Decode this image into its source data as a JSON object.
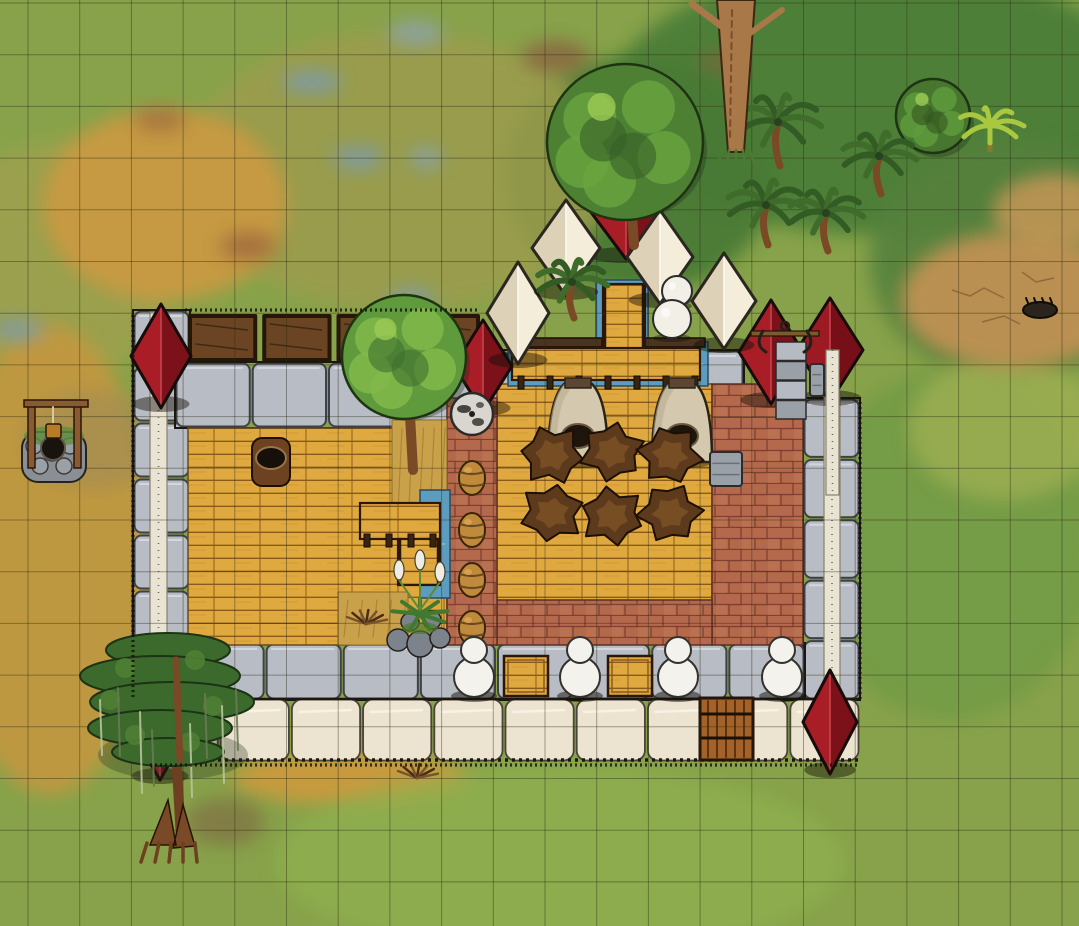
{
  "map": {
    "canvas": {
      "width": 1079,
      "height": 926
    },
    "grid": {
      "cell": 51.7,
      "offset_x": 28,
      "offset_y": 3,
      "color": "#2e2c14",
      "opacity": 0.42
    },
    "palette": {
      "grass_base": "#87a24a",
      "grass_dark": "#4c7e37",
      "grass_fresh": "#8fb14f",
      "dry_gold": "#c99a42",
      "marsh_olive": "#9c9c4e",
      "dirt_tan": "#bd9152",
      "water": "#5b9cbf",
      "stone_light": "#b8bcc5",
      "plaster_cream": "#ece4d0",
      "beam_white": "#e9e3d3",
      "wood_plank": "#e0a93f",
      "wood_line": "#8a5a1b",
      "brick": "#b4684c",
      "brick_line": "#7e4030",
      "roof_red": "#a81d26",
      "roof_red_dark": "#7c1119",
      "tent_white": "#f3edda",
      "tent_shade": "#ddd2b8",
      "canopy_green": "#4e8034",
      "trunk_brown": "#8b5a2b",
      "hide_brown": "#5e3a1c",
      "kiln_beige": "#d4c9ae",
      "ink": "#1c1710"
    },
    "terrain_patches": [
      {
        "name": "dark-grass-north",
        "cx": 880,
        "cy": 100,
        "rx": 270,
        "ry": 135,
        "color": "#4c7e37",
        "opacity": 0.95
      },
      {
        "name": "dark-grass-northeast",
        "cx": 1010,
        "cy": 260,
        "rx": 140,
        "ry": 120,
        "color": "#55813c",
        "opacity": 0.9
      },
      {
        "name": "dark-grass-trees",
        "cx": 640,
        "cy": 175,
        "rx": 135,
        "ry": 118,
        "color": "#497a35",
        "opacity": 0.95
      },
      {
        "name": "grass-east",
        "cx": 950,
        "cy": 545,
        "rx": 145,
        "ry": 175,
        "color": "#6f9a45",
        "opacity": 0.75
      },
      {
        "name": "marsh-olive",
        "cx": 400,
        "cy": 170,
        "rx": 215,
        "ry": 140,
        "color": "#9c9c4e",
        "opacity": 0.85
      },
      {
        "name": "marsh-left",
        "cx": 60,
        "cy": 260,
        "rx": 120,
        "ry": 120,
        "color": "#a3a050",
        "opacity": 0.7
      },
      {
        "name": "gold-topleft",
        "cx": 165,
        "cy": 205,
        "rx": 122,
        "ry": 96,
        "color": "#c99a42",
        "opacity": 0.95
      },
      {
        "name": "gold-left",
        "cx": 50,
        "cy": 560,
        "rx": 102,
        "ry": 235,
        "color": "#c4973f",
        "opacity": 0.9
      },
      {
        "name": "gold-bottom-strip",
        "cx": 350,
        "cy": 778,
        "rx": 118,
        "ry": 27,
        "color": "#cf9a3c",
        "opacity": 0.9
      },
      {
        "name": "fresh-grass-south",
        "cx": 560,
        "cy": 862,
        "rx": 285,
        "ry": 95,
        "color": "#8fb14f",
        "opacity": 0.7
      },
      {
        "name": "grass-yellow-east",
        "cx": 1005,
        "cy": 428,
        "rx": 96,
        "ry": 72,
        "color": "#9cae51",
        "opacity": 0.85
      },
      {
        "name": "dirt-east",
        "cx": 1015,
        "cy": 300,
        "rx": 114,
        "ry": 68,
        "color": "#bd9152",
        "opacity": 0.97
      },
      {
        "name": "dirt-east-upper",
        "cx": 1055,
        "cy": 212,
        "rx": 62,
        "ry": 38,
        "color": "#c09555",
        "opacity": 0.9
      },
      {
        "name": "mud-near-well",
        "cx": 95,
        "cy": 440,
        "rx": 72,
        "ry": 48,
        "color": "#9f8a56",
        "opacity": 0.6
      },
      {
        "name": "red-spot-1",
        "cx": 556,
        "cy": 57,
        "rx": 34,
        "ry": 16,
        "color": "#8a5b3f",
        "opacity": 0.75
      },
      {
        "name": "red-spot-2",
        "cx": 248,
        "cy": 246,
        "rx": 28,
        "ry": 14,
        "color": "#96603d",
        "opacity": 0.7
      },
      {
        "name": "red-spot-3",
        "cx": 225,
        "cy": 822,
        "rx": 40,
        "ry": 24,
        "color": "#7d5a41",
        "opacity": 0.5
      },
      {
        "name": "red-spot-4",
        "cx": 160,
        "cy": 120,
        "rx": 26,
        "ry": 12,
        "color": "#96603d",
        "opacity": 0.6
      },
      {
        "name": "red-spot-5",
        "cx": 722,
        "cy": 62,
        "rx": 22,
        "ry": 11,
        "color": "#8a5b3f",
        "opacity": 0.6
      },
      {
        "name": "puddle-1",
        "cx": 312,
        "cy": 82,
        "rx": 30,
        "ry": 11,
        "color": "#7d9bb0",
        "opacity": 0.85
      },
      {
        "name": "puddle-2",
        "cx": 358,
        "cy": 158,
        "rx": 25,
        "ry": 12,
        "color": "#7d9bb0",
        "opacity": 0.8
      },
      {
        "name": "puddle-3",
        "cx": 426,
        "cy": 158,
        "rx": 16,
        "ry": 11,
        "color": "#86a2b4",
        "opacity": 0.8
      },
      {
        "name": "puddle-4",
        "cx": 412,
        "cy": 300,
        "rx": 23,
        "ry": 12,
        "color": "#7d9bb0",
        "opacity": 0.8
      },
      {
        "name": "puddle-5",
        "cx": 416,
        "cy": 33,
        "rx": 28,
        "ry": 12,
        "color": "#8aa4b4",
        "opacity": 0.8
      },
      {
        "name": "puddle-6",
        "cx": 18,
        "cy": 330,
        "rx": 26,
        "ry": 11,
        "color": "#7d9bb0",
        "opacity": 0.8
      }
    ],
    "structures": [
      {
        "type": "stone_row",
        "name": "left-wall",
        "x": 133,
        "y": 310,
        "w": 57,
        "h": 392,
        "dir": "v",
        "block": 56
      },
      {
        "type": "beam",
        "name": "left-wall-beam",
        "x": 150,
        "y": 312,
        "w": 17,
        "h": 388
      },
      {
        "type": "trough_row",
        "name": "planter-troughs",
        "x": 188,
        "y": 314,
        "w": 292,
        "h": 48,
        "count": 4
      },
      {
        "type": "stone_row",
        "name": "top-wall",
        "x": 175,
        "y": 362,
        "w": 305,
        "h": 66,
        "dir": "h",
        "block": 77
      },
      {
        "type": "stone_row",
        "name": "entrance-left-pier",
        "x": 478,
        "y": 350,
        "w": 32,
        "h": 72,
        "dir": "h",
        "block": 32
      },
      {
        "type": "stone_row",
        "name": "entrance-right-pier",
        "x": 700,
        "y": 350,
        "w": 44,
        "h": 72,
        "dir": "h",
        "block": 44
      },
      {
        "type": "stone_row",
        "name": "right-wall",
        "x": 803,
        "y": 398,
        "w": 57,
        "h": 302,
        "dir": "v",
        "block": 56
      },
      {
        "type": "beam",
        "name": "right-wall-beam",
        "x": 824,
        "y": 352,
        "w": 16,
        "h": 348
      },
      {
        "type": "stone_row",
        "name": "bottom-walkway",
        "x": 188,
        "y": 643,
        "w": 617,
        "h": 57,
        "dir": "h",
        "block": 77
      },
      {
        "type": "plaster_row",
        "name": "bottom-wall",
        "x": 148,
        "y": 698,
        "w": 712,
        "h": 64,
        "block": 71
      },
      {
        "type": "wood_floor",
        "name": "left-hall-floor",
        "x": 188,
        "y": 428,
        "w": 259,
        "h": 217
      },
      {
        "type": "wood_floor",
        "name": "right-hall-floor",
        "x": 497,
        "y": 384,
        "w": 215,
        "h": 218
      },
      {
        "type": "brick_floor",
        "name": "right-brick-floor",
        "x": 712,
        "y": 384,
        "w": 91,
        "h": 261
      },
      {
        "type": "brick_floor",
        "name": "bottom-brick-floor",
        "x": 497,
        "y": 600,
        "w": 215,
        "h": 45
      },
      {
        "type": "brick_floor",
        "name": "divider-brick-wall",
        "x": 447,
        "y": 398,
        "w": 50,
        "h": 247
      },
      {
        "type": "dry_tile",
        "name": "dry-grass-tile",
        "x": 392,
        "y": 420,
        "w": 55,
        "h": 100
      },
      {
        "type": "dry_tile",
        "name": "straw-tile",
        "x": 338,
        "y": 592,
        "w": 70,
        "h": 53
      },
      {
        "type": "water",
        "name": "moat-channel",
        "x": 508,
        "y": 342,
        "w": 200,
        "h": 44
      },
      {
        "type": "water",
        "name": "entry-stream",
        "x": 596,
        "y": 280,
        "w": 52,
        "h": 70
      },
      {
        "type": "water",
        "name": "garden-channel",
        "x": 420,
        "y": 490,
        "w": 30,
        "h": 108
      },
      {
        "type": "beam_dark",
        "name": "dock-beam-left",
        "x": 512,
        "y": 338,
        "w": 90,
        "h": 9
      },
      {
        "type": "beam_dark",
        "name": "dock-beam-right",
        "x": 645,
        "y": 338,
        "w": 60,
        "h": 9
      },
      {
        "type": "plank_deck",
        "name": "entry-bridge",
        "x": 603,
        "y": 284,
        "w": 42,
        "h": 72,
        "dir": "v"
      },
      {
        "type": "plank_deck",
        "name": "moat-dock",
        "x": 512,
        "y": 348,
        "w": 188,
        "h": 32,
        "dir": "h"
      },
      {
        "type": "post_row",
        "name": "dock-posts",
        "x": 518,
        "y": 376,
        "w": 180,
        "count": 7
      },
      {
        "type": "gate",
        "name": "wooden-gate",
        "x": 700,
        "y": 698,
        "w": 53,
        "h": 62
      },
      {
        "type": "plank_deck",
        "name": "counter-top",
        "x": 360,
        "y": 503,
        "w": 80,
        "h": 36,
        "dir": "h"
      },
      {
        "type": "plank_deck",
        "name": "counter-side",
        "x": 398,
        "y": 539,
        "w": 42,
        "h": 46,
        "dir": "v"
      },
      {
        "type": "post_row",
        "name": "counter-posts",
        "x": 364,
        "y": 534,
        "w": 72,
        "count": 4
      }
    ],
    "objects": [
      {
        "type": "pyramid",
        "name": "tower-northwest-roof",
        "cx": 161,
        "cy": 356,
        "rx": 30,
        "ry": 52,
        "c1": "#a81d26",
        "c2": "#7c1119",
        "ridge": "#c2424b"
      },
      {
        "type": "pyramid",
        "name": "tower-northcenter-roof",
        "cx": 483,
        "cy": 366,
        "rx": 29,
        "ry": 46,
        "c1": "#a81d26",
        "c2": "#7c1119",
        "ridge": "#c2424b"
      },
      {
        "type": "pyramid",
        "name": "forge-tent-left",
        "cx": 771,
        "cy": 352,
        "rx": 32,
        "ry": 52,
        "c1": "#a81d26",
        "c2": "#7c1119",
        "ridge": "#c2424b"
      },
      {
        "type": "pyramid",
        "name": "forge-tent-right",
        "cx": 830,
        "cy": 350,
        "rx": 33,
        "ry": 52,
        "c1": "#9c1a22",
        "c2": "#760f17",
        "ridge": "#c2424b"
      },
      {
        "type": "pyramid",
        "name": "tower-southwest-roof",
        "cx": 160,
        "cy": 728,
        "rx": 30,
        "ry": 52,
        "c1": "#a81d26",
        "c2": "#7c1119",
        "ridge": "#c2424b"
      },
      {
        "type": "pyramid",
        "name": "tower-southeast-roof",
        "cx": 830,
        "cy": 722,
        "rx": 27,
        "ry": 52,
        "c1": "#a81d26",
        "c2": "#7c1119",
        "ridge": "#c2424b"
      },
      {
        "type": "pyramid",
        "name": "red-tent-north",
        "cx": 626,
        "cy": 203,
        "rx": 42,
        "ry": 56,
        "c1": "#a81d26",
        "c2": "#7c1119",
        "ridge": "#c2424b"
      },
      {
        "type": "pyramid",
        "name": "white-tent-1",
        "cx": 518,
        "cy": 313,
        "rx": 31,
        "ry": 51,
        "c1": "#ddd2b8",
        "c2": "#f3edda",
        "ridge": "#fbf8ee",
        "outline": "#2b2620"
      },
      {
        "type": "pyramid",
        "name": "white-tent-2",
        "cx": 566,
        "cy": 248,
        "rx": 34,
        "ry": 48,
        "c1": "#ddd2b8",
        "c2": "#f3edda",
        "ridge": "#fbf8ee",
        "outline": "#2b2620"
      },
      {
        "type": "pyramid",
        "name": "white-tent-3",
        "cx": 660,
        "cy": 257,
        "rx": 33,
        "ry": 47,
        "c1": "#ddd2b8",
        "c2": "#f3edda",
        "ridge": "#fbf8ee",
        "outline": "#2b2620"
      },
      {
        "type": "pyramid",
        "name": "white-tent-4",
        "cx": 724,
        "cy": 301,
        "rx": 32,
        "ry": 48,
        "c1": "#ddd2b8",
        "c2": "#f3edda",
        "ridge": "#fbf8ee",
        "outline": "#2b2620"
      },
      {
        "type": "sphere",
        "name": "white-boulder-small",
        "cx": 677,
        "cy": 291,
        "r": 15
      },
      {
        "type": "sphere",
        "name": "white-boulder-large",
        "cx": 672,
        "cy": 319,
        "r": 19
      },
      {
        "type": "chimney",
        "name": "forge-chimney",
        "x": 776,
        "y": 342,
        "w": 30,
        "h": 78
      },
      {
        "type": "anchor_tool",
        "name": "forge-anchor-tool",
        "cx": 785,
        "cy": 333
      },
      {
        "type": "stone_block",
        "name": "forge-cylinder",
        "x": 810,
        "y": 364,
        "w": 14,
        "h": 32
      },
      {
        "type": "beam_over",
        "name": "right-wall-beam-upper",
        "x": 826,
        "y": 350,
        "w": 13,
        "h": 145
      },
      {
        "type": "millstone",
        "name": "millstone",
        "cx": 472,
        "cy": 414,
        "r": 21
      },
      {
        "type": "tree",
        "name": "courtyard-tree",
        "cx": 404,
        "cy": 357,
        "r": 62,
        "base": "#5f9a3c",
        "blob": "#82b94a",
        "dark": "#3f7030",
        "trunk": [
          413,
          470
        ]
      },
      {
        "type": "tree",
        "name": "north-oak-tree",
        "cx": 625,
        "cy": 142,
        "r": 78,
        "base": "#4e8034",
        "blob": "#69a33e",
        "dark": "#375f28",
        "trunk": [
          634,
          245
        ]
      },
      {
        "type": "tree",
        "name": "east-round-tree",
        "cx": 933,
        "cy": 116,
        "r": 37,
        "base": "#47772f",
        "blob": "#5f9a3c",
        "dark": "#33571f"
      },
      {
        "type": "palm",
        "name": "palm-tree-1",
        "cx": 778,
        "cy": 122,
        "s": 44
      },
      {
        "type": "palm",
        "name": "palm-tree-2",
        "cx": 766,
        "cy": 205,
        "s": 40
      },
      {
        "type": "palm",
        "name": "palm-tree-3",
        "cx": 826,
        "cy": 213,
        "s": 38
      },
      {
        "type": "palm",
        "name": "palm-tree-4",
        "cx": 879,
        "cy": 156,
        "s": 38
      },
      {
        "type": "palm",
        "name": "palm-tree-camp",
        "cx": 572,
        "cy": 282,
        "s": 36
      },
      {
        "type": "banana",
        "name": "banana-plant",
        "cx": 990,
        "cy": 126,
        "s": 34
      },
      {
        "type": "trunk_tree",
        "name": "tall-tree-trunk",
        "cx": 736,
        "h": 152
      },
      {
        "type": "kiln",
        "name": "kiln-left",
        "cx": 578,
        "top": 382
      },
      {
        "type": "kiln",
        "name": "kiln-right",
        "cx": 682,
        "top": 382
      },
      {
        "type": "hide",
        "name": "hide-pelt-1",
        "cx": 552,
        "cy": 455,
        "r": 31,
        "rot": 8
      },
      {
        "type": "hide",
        "name": "hide-pelt-2",
        "cx": 612,
        "cy": 452,
        "r": 31,
        "rot": 40
      },
      {
        "type": "hide",
        "name": "hide-pelt-3",
        "cx": 670,
        "cy": 455,
        "r": 31,
        "rot": 70
      },
      {
        "type": "hide",
        "name": "hide-pelt-4",
        "cx": 552,
        "cy": 513,
        "r": 31,
        "rot": 100
      },
      {
        "type": "hide",
        "name": "hide-pelt-5",
        "cx": 612,
        "cy": 516,
        "r": 31,
        "rot": 20
      },
      {
        "type": "hide",
        "name": "hide-pelt-6",
        "cx": 670,
        "cy": 513,
        "r": 31,
        "rot": 55
      },
      {
        "type": "stone_block",
        "name": "stone-slab",
        "x": 710,
        "y": 452,
        "w": 32,
        "h": 34
      },
      {
        "type": "sack",
        "name": "grain-sack",
        "x": 252,
        "y": 438,
        "w": 38,
        "h": 48
      },
      {
        "type": "barrel",
        "name": "barrel-1",
        "cx": 472,
        "cy": 478
      },
      {
        "type": "barrel",
        "name": "barrel-2",
        "cx": 472,
        "cy": 530
      },
      {
        "type": "barrel",
        "name": "barrel-3",
        "cx": 472,
        "cy": 580
      },
      {
        "type": "barrel",
        "name": "barrel-4",
        "cx": 472,
        "cy": 628
      },
      {
        "type": "crate",
        "name": "crate-left",
        "x": 504,
        "y": 656,
        "w": 44,
        "h": 40
      },
      {
        "type": "crate",
        "name": "crate-right",
        "x": 608,
        "y": 656,
        "w": 44,
        "h": 40
      },
      {
        "type": "snowman",
        "name": "white-figure-1",
        "cx": 474,
        "cy": 670
      },
      {
        "type": "snowman",
        "name": "white-figure-2",
        "cx": 580,
        "cy": 670
      },
      {
        "type": "snowman",
        "name": "white-figure-3",
        "cx": 678,
        "cy": 670
      },
      {
        "type": "snowman",
        "name": "white-figure-4",
        "cx": 782,
        "cy": 670
      },
      {
        "type": "lily",
        "name": "pond-plant",
        "cx": 420,
        "cy": 610
      },
      {
        "type": "sticks",
        "name": "kindling-inside",
        "cx": 366,
        "cy": 624
      },
      {
        "type": "sticks",
        "name": "kindling-outside",
        "cx": 417,
        "cy": 778
      },
      {
        "type": "log",
        "name": "fallen-log",
        "cx": 1040,
        "cy": 310
      },
      {
        "type": "cracks",
        "name": "dirt-cracks",
        "cx": 1012,
        "cy": 300
      },
      {
        "type": "well",
        "name": "stone-well",
        "x": 22,
        "y": 396
      },
      {
        "type": "cypress",
        "name": "cypress-tree",
        "cx": 165
      },
      {
        "type": "stipple",
        "name": "wall-stipple-top",
        "x1": 185,
        "y1": 310,
        "x2": 480,
        "y2": 310
      },
      {
        "type": "stipple",
        "name": "wall-stipple-left",
        "x1": 133,
        "y1": 315,
        "x2": 133,
        "y2": 700
      },
      {
        "type": "stipple",
        "name": "wall-stipple-bottom",
        "x1": 150,
        "y1": 765,
        "x2": 858,
        "y2": 765
      },
      {
        "type": "stipple",
        "name": "wall-stipple-right",
        "x1": 860,
        "y1": 402,
        "x2": 860,
        "y2": 700
      }
    ]
  }
}
